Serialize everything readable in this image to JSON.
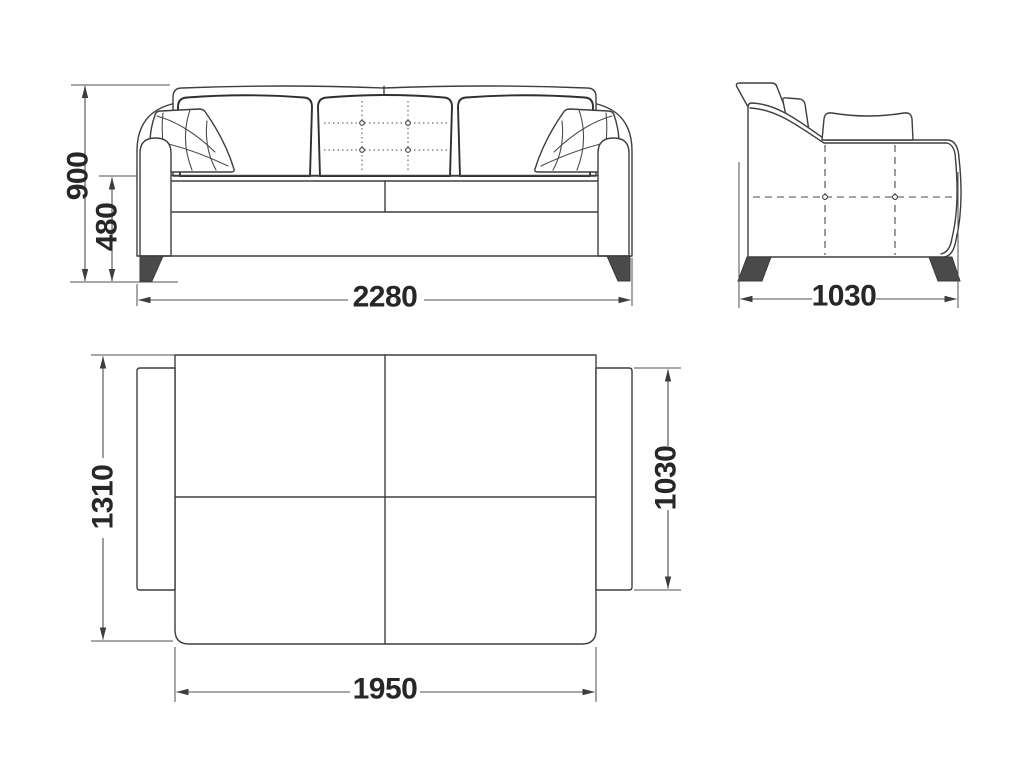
{
  "drawing": {
    "type": "furniture-technical-drawing",
    "subject": "sofa-bed three-view dimension drawing",
    "units_shown": "mm",
    "colors": {
      "background": "#ffffff",
      "line": "#3e3e3e",
      "dimension_line": "#4f4f4f",
      "leg_fill": "#4a4a4a",
      "text": "#272727"
    }
  },
  "views": {
    "front": {
      "dims": {
        "overall_height": "900",
        "seat_height": "480",
        "overall_width": "2280"
      }
    },
    "side": {
      "dims": {
        "overall_depth": "1030"
      }
    },
    "plan": {
      "dims": {
        "unfolded_length": "1310",
        "seat_depth": "1030",
        "inner_width": "1950"
      }
    }
  }
}
